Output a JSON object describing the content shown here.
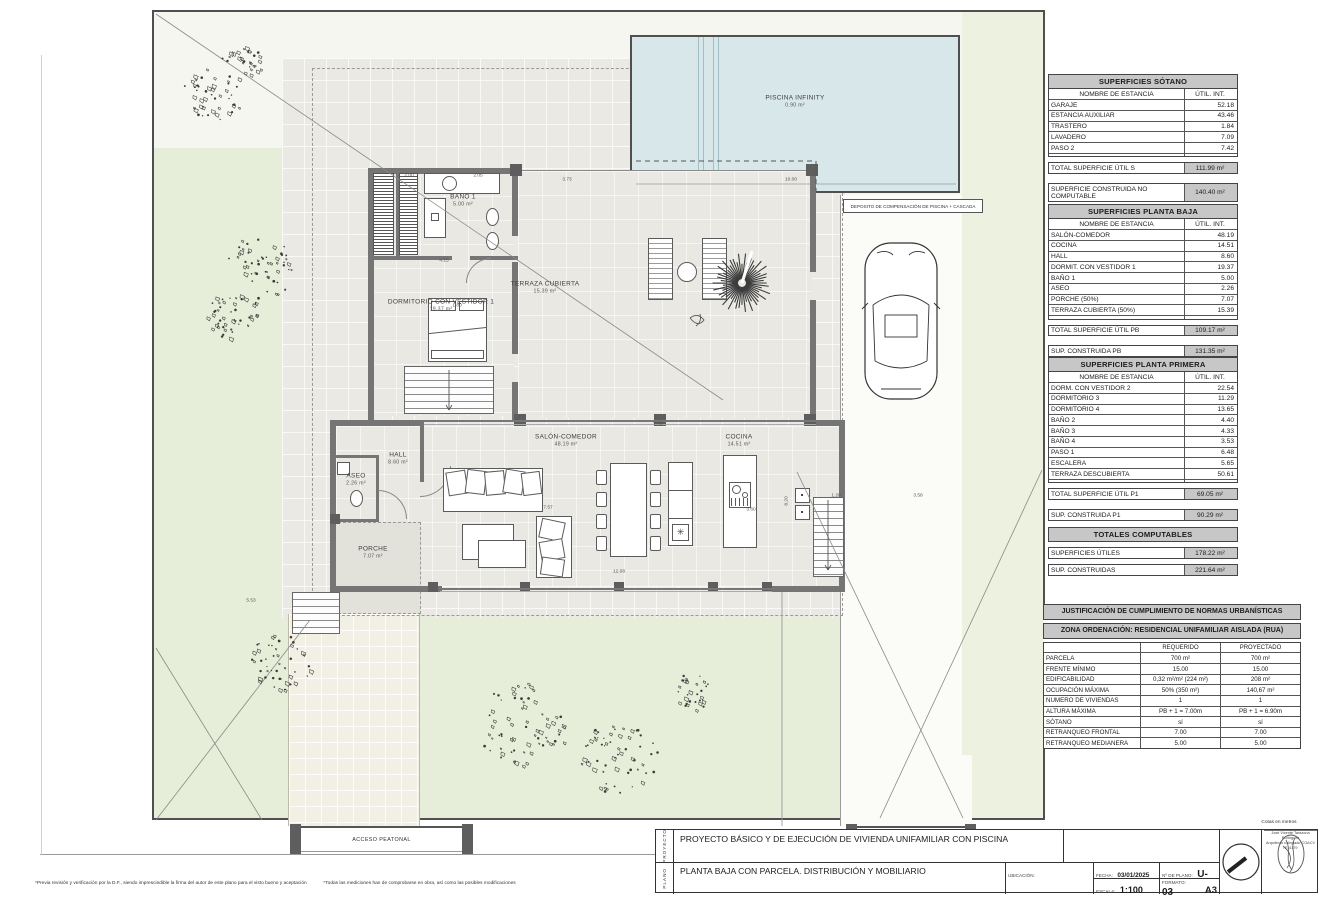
{
  "plan": {
    "pool_label": "PISCINA INFINITY",
    "pool_area": "0.90 m²",
    "deposito": "DEPOSITO DE COMPENSACIÓN DE PISCINA + CASCADA",
    "rooms": [
      {
        "name": "BAÑO 1",
        "area": "5.00 m²"
      },
      {
        "name": "DORMITORIO CON VESTIDOR 1",
        "area": "19.37 m²"
      },
      {
        "name": "TERRAZA CUBIERTA",
        "area": "15.39 m²"
      },
      {
        "name": "HALL",
        "area": "8.60 m²"
      },
      {
        "name": "ASEO",
        "area": "2.26 m²"
      },
      {
        "name": "SALÓN-COMEDOR",
        "area": "48.19 m²"
      },
      {
        "name": "COCINA",
        "area": "14.51 m²"
      },
      {
        "name": "PORCHE",
        "area": "7.07 m²"
      }
    ],
    "accesses": {
      "peatonal": "ACCESO PEATONAL",
      "rodado": "ACCESO RODADO"
    },
    "dims": [
      "2.00",
      "2.05",
      "3.73",
      "4.15",
      "1.80",
      "10.00",
      "7.57",
      "12.08",
      "9.82",
      "3.60",
      "8.20",
      "1.20",
      "3.58",
      "5.53"
    ]
  },
  "tables": {
    "sotano": {
      "title": "SUPERFICIES SÓTANO",
      "headers": [
        "NOMBRE DE ESTANCIA",
        "ÚTIL. INT."
      ],
      "rows": [
        [
          "GARAJE",
          "52.18"
        ],
        [
          "ESTANCIA AUXILIAR",
          "43.46"
        ],
        [
          "TRASTERO",
          "1.84"
        ],
        [
          "LAVADERO",
          "7.09"
        ],
        [
          "PASO 2",
          "7.42"
        ],
        [
          "",
          ""
        ]
      ],
      "total": [
        "TOTAL SUPERFICIE ÚTIL S",
        "111.99 m²"
      ],
      "sub": [
        "SUPERFICIE CONSTRUIDA NO COMPUTABLE",
        "140.40 m²"
      ]
    },
    "planta_baja": {
      "title": "SUPERFICIES  PLANTA BAJA",
      "headers": [
        "NOMBRE DE ESTANCIA",
        "ÚTIL. INT."
      ],
      "rows": [
        [
          "SALÓN-COMEDOR",
          "48.19"
        ],
        [
          "COCINA",
          "14.51"
        ],
        [
          "HALL",
          "8.60"
        ],
        [
          "DORMIT. CON VESTIDOR 1",
          "19.37"
        ],
        [
          "BAÑO 1",
          "5.00"
        ],
        [
          "ASEO",
          "2.26"
        ],
        [
          "PORCHE (50%)",
          "7.07"
        ],
        [
          "TERRAZA CUBIERTA (50%)",
          "15.39"
        ],
        [
          "",
          ""
        ]
      ],
      "total": [
        "TOTAL SUPERFICIE ÚTIL PB",
        "109.17 m²"
      ],
      "sub": [
        "SUP. CONSTRUIDA PB",
        "131.35 m²"
      ]
    },
    "planta_primera": {
      "title": "SUPERFICIES PLANTA PRIMERA",
      "headers": [
        "NOMBRE DE ESTANCIA",
        "ÚTIL. INT."
      ],
      "rows": [
        [
          "DORM. CON VESTIDOR 2",
          "22.54"
        ],
        [
          "DORMITORIO 3",
          "11.29"
        ],
        [
          "DORMITORIO 4",
          "13.65"
        ],
        [
          "BAÑO 2",
          "4.40"
        ],
        [
          "BAÑO 3",
          "4.33"
        ],
        [
          "BAÑO 4",
          "3.53"
        ],
        [
          "PASO 1",
          "6.48"
        ],
        [
          "ESCALERA",
          "5.65"
        ],
        [
          "TERRAZA DESCUBIERTA",
          "50.61"
        ],
        [
          "",
          ""
        ]
      ],
      "total": [
        "TOTAL SUPERFICIE ÚTIL P1",
        "69.05 m²"
      ],
      "sub": [
        "SUP. CONSTRUIDA P1",
        "90.29 m²"
      ]
    },
    "totales": {
      "title": "TOTALES COMPUTABLES",
      "rows": [
        [
          "SUPERFICIES ÚTILES",
          "178.22 m²"
        ],
        [
          "SUP. CONSTRUIDAS",
          "221.64 m²"
        ]
      ]
    },
    "justificacion": {
      "title1": "JUSTIFICACIÓN DE CUMPLIMIENTO DE NORMAS URBANÍSTICAS",
      "title2": "ZONA ORDENACIÓN: RESIDENCIAL UNIFAMILIAR AISLADA (RUA)",
      "headers": [
        "",
        "REQUERIDO",
        "PROYECTADO"
      ],
      "rows": [
        [
          "PARCELA",
          "700 m²",
          "700 m²"
        ],
        [
          "FRENTE MÍNIMO",
          "15.00",
          "15.00"
        ],
        [
          "EDIFICABILIDAD",
          "0,32 m²/m² (224 m²)",
          "208 m²"
        ],
        [
          "OCUPACIÓN MÁXIMA",
          "50% (350 m²)",
          "140,67 m²"
        ],
        [
          "NUMERO DE VIVIENDAS",
          "1",
          "1"
        ],
        [
          "ALTURA MÁXIMA",
          "PB + 1 = 7.00m",
          "PB + 1 = 6.90m"
        ],
        [
          "SÓTANO",
          "sí",
          "sí"
        ],
        [
          "RETRANQUEO FRONTAL",
          "7.00",
          "7.00"
        ],
        [
          "RETRANQUEO MEDIANERA",
          "5.00",
          "5.00"
        ]
      ]
    }
  },
  "titleblock": {
    "proyecto_label": "PROYECTO",
    "plano_label": "PLANO",
    "proyecto": "PROYECTO BÁSICO Y DE EJECUCIÓN DE  VIVIENDA UNIFAMILIAR CON PISCINA",
    "plano": "PLANTA BAJA CON PARCELA. DISTRIBUCIÓN Y MOBILIARIO",
    "ubicacion_label": "UBICACIÓN:",
    "fecha_label": "FECHA:",
    "fecha": "03/01/2025",
    "nplano_label": "Nº DE PLANO:",
    "nplano": "U-03",
    "escala_label": "ESCALA:",
    "escala": "1:100",
    "formato_label": "FORMATO:",
    "formato": "A3"
  },
  "stamp": {
    "cotas": "Cotas en metros",
    "name": "José Vicente Tarazona Rodríguez",
    "title": "Arquitecto colegiado COACV nº14179"
  },
  "footnotes": {
    "a": "*Previa revisión y verificación por la D.F., siendo imprescindible la firma del autor de este plano para el visto bueno y aceptación",
    "b": "*Todas las mediciones han de comprobarse en obra, así como las posibles modificaciones"
  }
}
